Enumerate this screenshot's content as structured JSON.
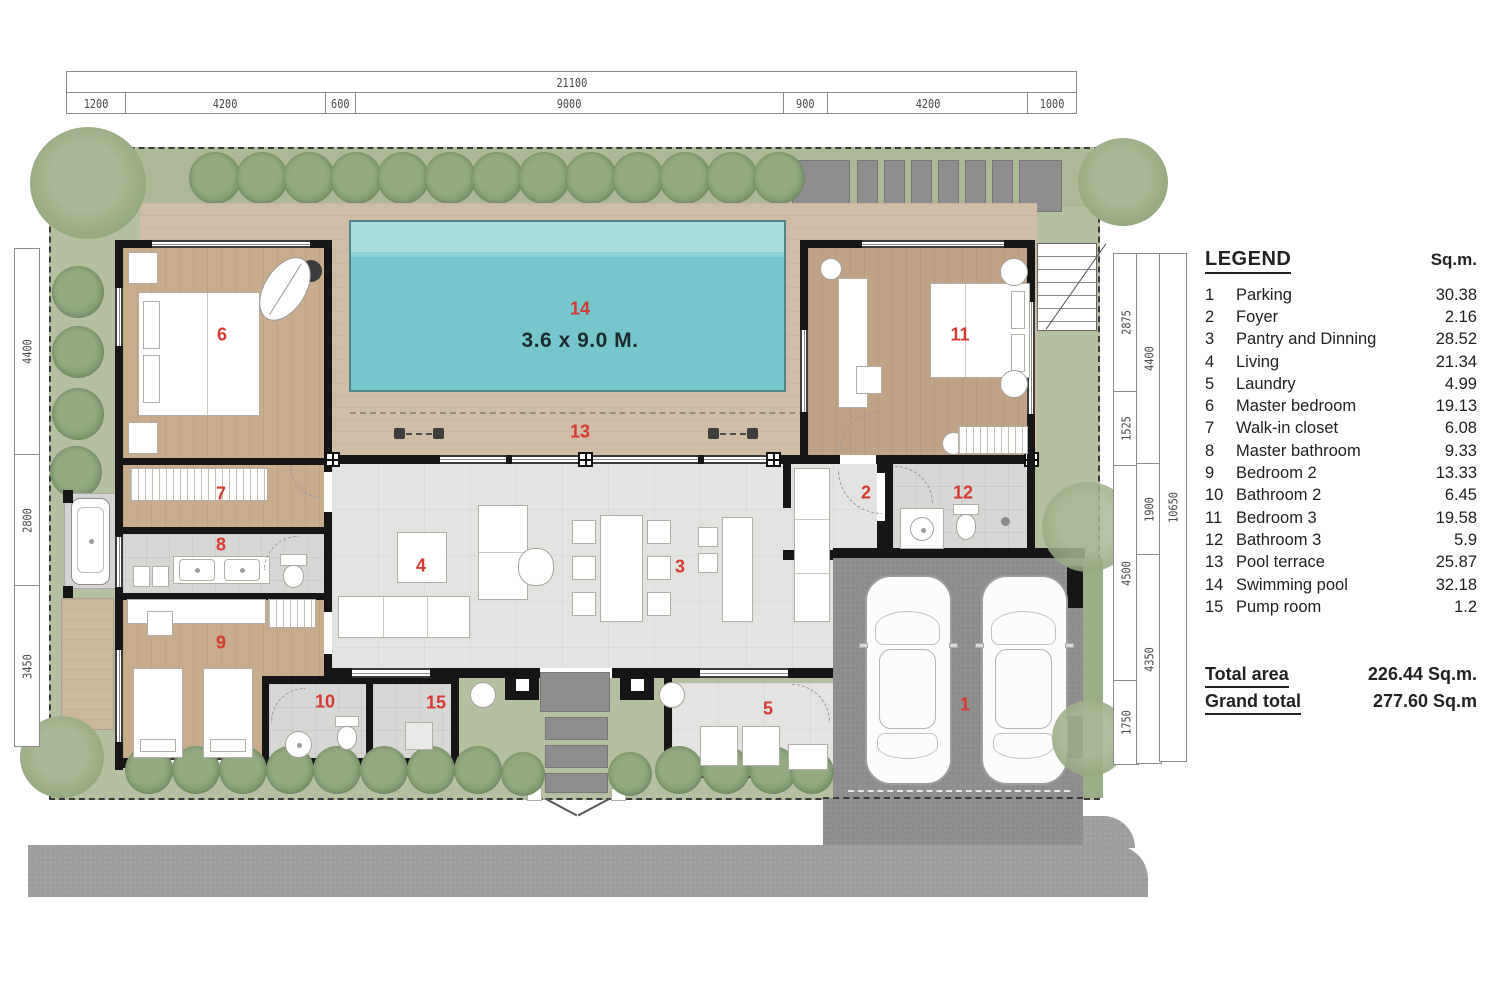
{
  "dimensions": {
    "top": {
      "total": "21100",
      "segments": [
        "1200",
        "4200",
        "600",
        "9000",
        "900",
        "4200",
        "1000"
      ]
    },
    "left": {
      "segments": [
        "4400",
        "2800",
        "3450"
      ]
    },
    "right": {
      "inner": [
        "2875",
        "1525",
        "4500",
        "1750"
      ],
      "middle": [
        "4400",
        "1900",
        "4350"
      ],
      "outer": [
        "10650"
      ]
    }
  },
  "pool": {
    "number": "14",
    "size_label": "3.6 x 9.0 M."
  },
  "plan": {
    "labels": [
      {
        "room": "parking",
        "num": "1"
      },
      {
        "room": "foyer",
        "num": "2"
      },
      {
        "room": "pantry-and-dinning",
        "num": "3"
      },
      {
        "room": "living",
        "num": "4"
      },
      {
        "room": "laundry",
        "num": "5"
      },
      {
        "room": "master-bedroom",
        "num": "6"
      },
      {
        "room": "walk-in-closet",
        "num": "7"
      },
      {
        "room": "master-bathroom",
        "num": "8"
      },
      {
        "room": "bedroom-2",
        "num": "9"
      },
      {
        "room": "bathroom-2",
        "num": "10"
      },
      {
        "room": "bedroom-3",
        "num": "11"
      },
      {
        "room": "bathroom-3",
        "num": "12"
      },
      {
        "room": "pool-terrace",
        "num": "13"
      },
      {
        "room": "swimming-pool",
        "num": "14"
      },
      {
        "room": "pump-room",
        "num": "15"
      }
    ]
  },
  "legend": {
    "title": "LEGEND",
    "unit_header": "Sq.m.",
    "items": [
      {
        "num": "1",
        "name": "Parking",
        "area": "30.38"
      },
      {
        "num": "2",
        "name": "Foyer",
        "area": "2.16"
      },
      {
        "num": "3",
        "name": "Pantry and Dinning",
        "area": "28.52"
      },
      {
        "num": "4",
        "name": "Living",
        "area": "21.34"
      },
      {
        "num": "5",
        "name": "Laundry",
        "area": "4.99"
      },
      {
        "num": "6",
        "name": "Master bedroom",
        "area": "19.13"
      },
      {
        "num": "7",
        "name": "Walk-in closet",
        "area": "6.08"
      },
      {
        "num": "8",
        "name": "Master bathroom",
        "area": "9.33"
      },
      {
        "num": "9",
        "name": "Bedroom 2",
        "area": "13.33"
      },
      {
        "num": "10",
        "name": "Bathroom 2",
        "area": "6.45"
      },
      {
        "num": "11",
        "name": "Bedroom 3",
        "area": "19.58"
      },
      {
        "num": "12",
        "name": "Bathroom 3",
        "area": "5.9"
      },
      {
        "num": "13",
        "name": "Pool terrace",
        "area": "25.87"
      },
      {
        "num": "14",
        "name": "Swimming pool",
        "area": "32.18"
      },
      {
        "num": "15",
        "name": "Pump room",
        "area": "1.2"
      }
    ],
    "totals": [
      {
        "label": "Total area",
        "value": "226.44 Sq.m."
      },
      {
        "label": "Grand total",
        "value": "277.60 Sq.m"
      }
    ]
  },
  "colors": {
    "label_red": "#d5392f",
    "lawn_green": "#b5c0a0",
    "pool_water": "#77c6cc",
    "deck_tan": "#cfbda6",
    "wood_floor": "#c9ac8c",
    "concrete_gray": "#8d8d8d"
  }
}
